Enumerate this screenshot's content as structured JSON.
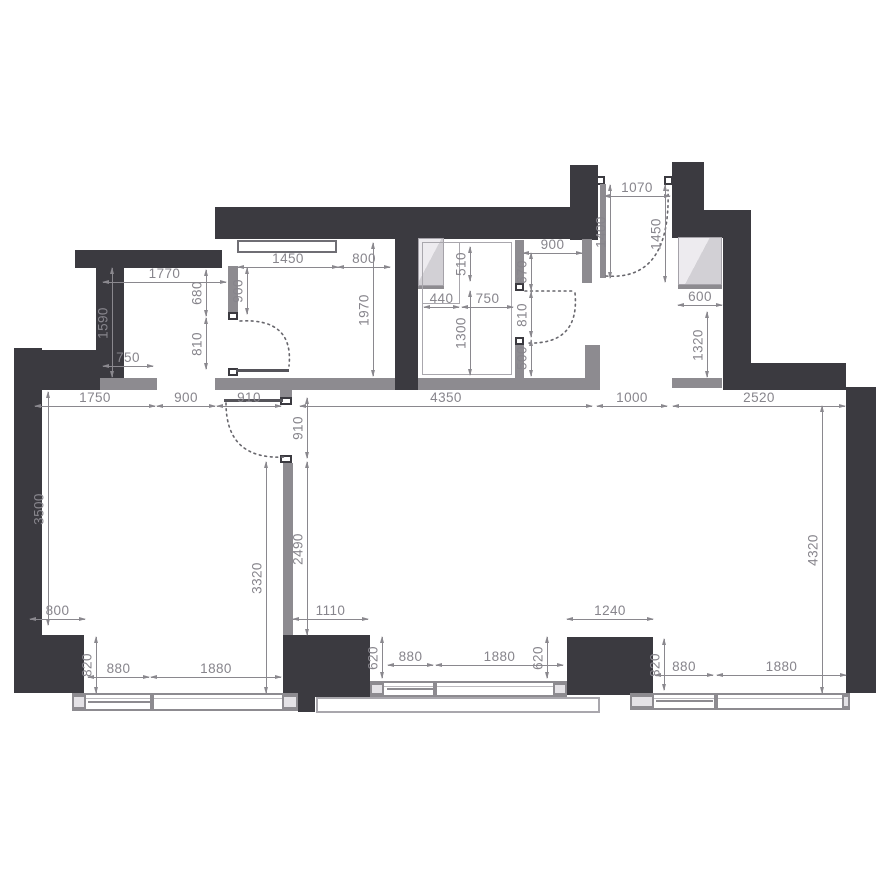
{
  "meta": {
    "drawing_type": "apartment floor plan",
    "units": "mm"
  },
  "colors": {
    "exterior_wall": "#3b3a40",
    "partition_wall": "#8d8b90",
    "dimension": "#87858c",
    "shaft_fill": "#d9d7db",
    "background": "#ffffff"
  },
  "dims": {
    "closet_width": "1770",
    "closet_height": "1590",
    "closet_inner": "750",
    "closet_door_top": "680",
    "closet_door": "810",
    "wardrobe_left": "1450",
    "wardrobe_right": "800",
    "wardrobe_wall": "900",
    "wardrobe_depth": "1970",
    "bath_niche_h": "510",
    "bath_niche_w": "440",
    "bath_mid": "750",
    "bath_length": "1300",
    "bath_corridor": "900",
    "bath_door_top": "670",
    "bath_door": "810",
    "bath_door_btm": "500",
    "entry_width": "1070",
    "entry_leaf": "1400",
    "entry_depth": "1450",
    "niche_width": "600",
    "niche_height": "1320",
    "chain_1": "1750",
    "chain_2": "900",
    "chain_3": "910",
    "chain_4": "4350",
    "chain_5": "1000",
    "chain_6": "2520",
    "living_height": "3500",
    "door_910": "910",
    "partition_len": "2490",
    "living_width": "3320",
    "dining_height": "4320",
    "pier_sw_w": "800",
    "pier_c_w": "1110",
    "pier_cr_w": "1240",
    "sill_sw": "820",
    "win_l_small": "880",
    "win_l_big": "1880",
    "sill_c_left": "620",
    "win_c_small": "880",
    "win_c_big": "1880",
    "sill_c_right": "620",
    "sill_se": "820",
    "win_r_small": "880",
    "win_r_big": "1880"
  }
}
